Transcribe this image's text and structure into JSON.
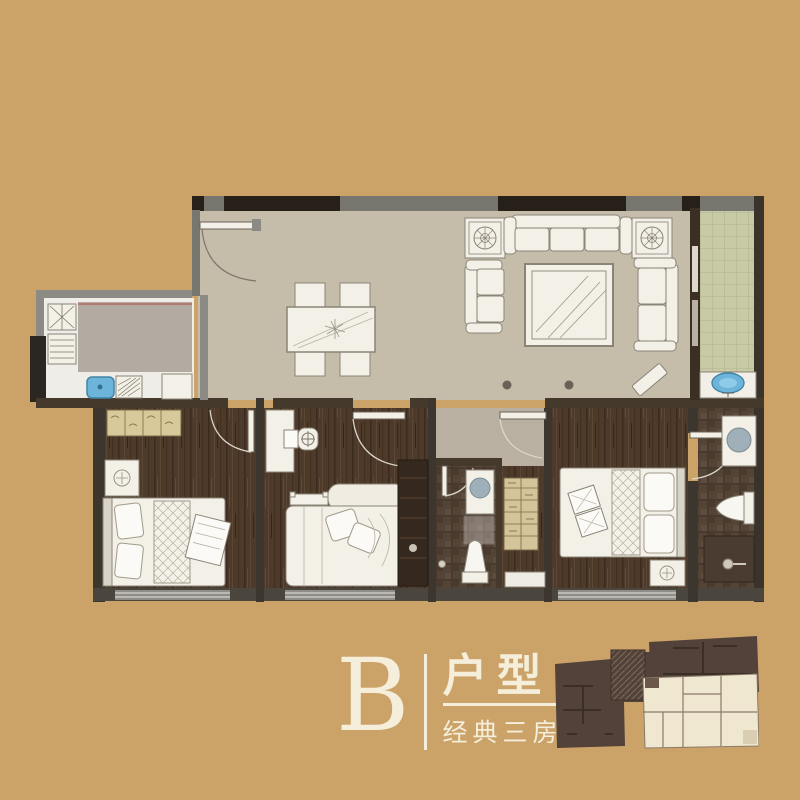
{
  "branding": {
    "unit_letter": "B",
    "unit_title": "户型",
    "unit_subtitle": "经典三房"
  },
  "colors": {
    "background": "#cba369",
    "cream": "#f5eeda",
    "wall_dark": "#262019",
    "wall_gray": "#77766f",
    "wall_brown": "#45392c",
    "floor_living": "#c9bfae",
    "floor_hall": "#b9b0a2",
    "floor_wood": "#4d3a2a",
    "floor_bath_tile": "#544436",
    "balcony_tile": "#c7caa5",
    "fixture_white": "#f3f0e8",
    "sink_blue": "#6cb4d9",
    "basin_gray": "#9fb0b8",
    "wardrobe_tan": "#d8c99b",
    "minimap_dark": "#53423a",
    "minimap_unit_highlight": "#f0e7d0"
  },
  "floorplan": {
    "rooms": [
      {
        "name": "entry"
      },
      {
        "name": "dining-area"
      },
      {
        "name": "living-room"
      },
      {
        "name": "kitchen"
      },
      {
        "name": "laundry-balcony"
      },
      {
        "name": "bedroom-1"
      },
      {
        "name": "bedroom-2"
      },
      {
        "name": "bathroom"
      },
      {
        "name": "hallway"
      },
      {
        "name": "master-bedroom"
      },
      {
        "name": "master-bathroom"
      }
    ]
  }
}
